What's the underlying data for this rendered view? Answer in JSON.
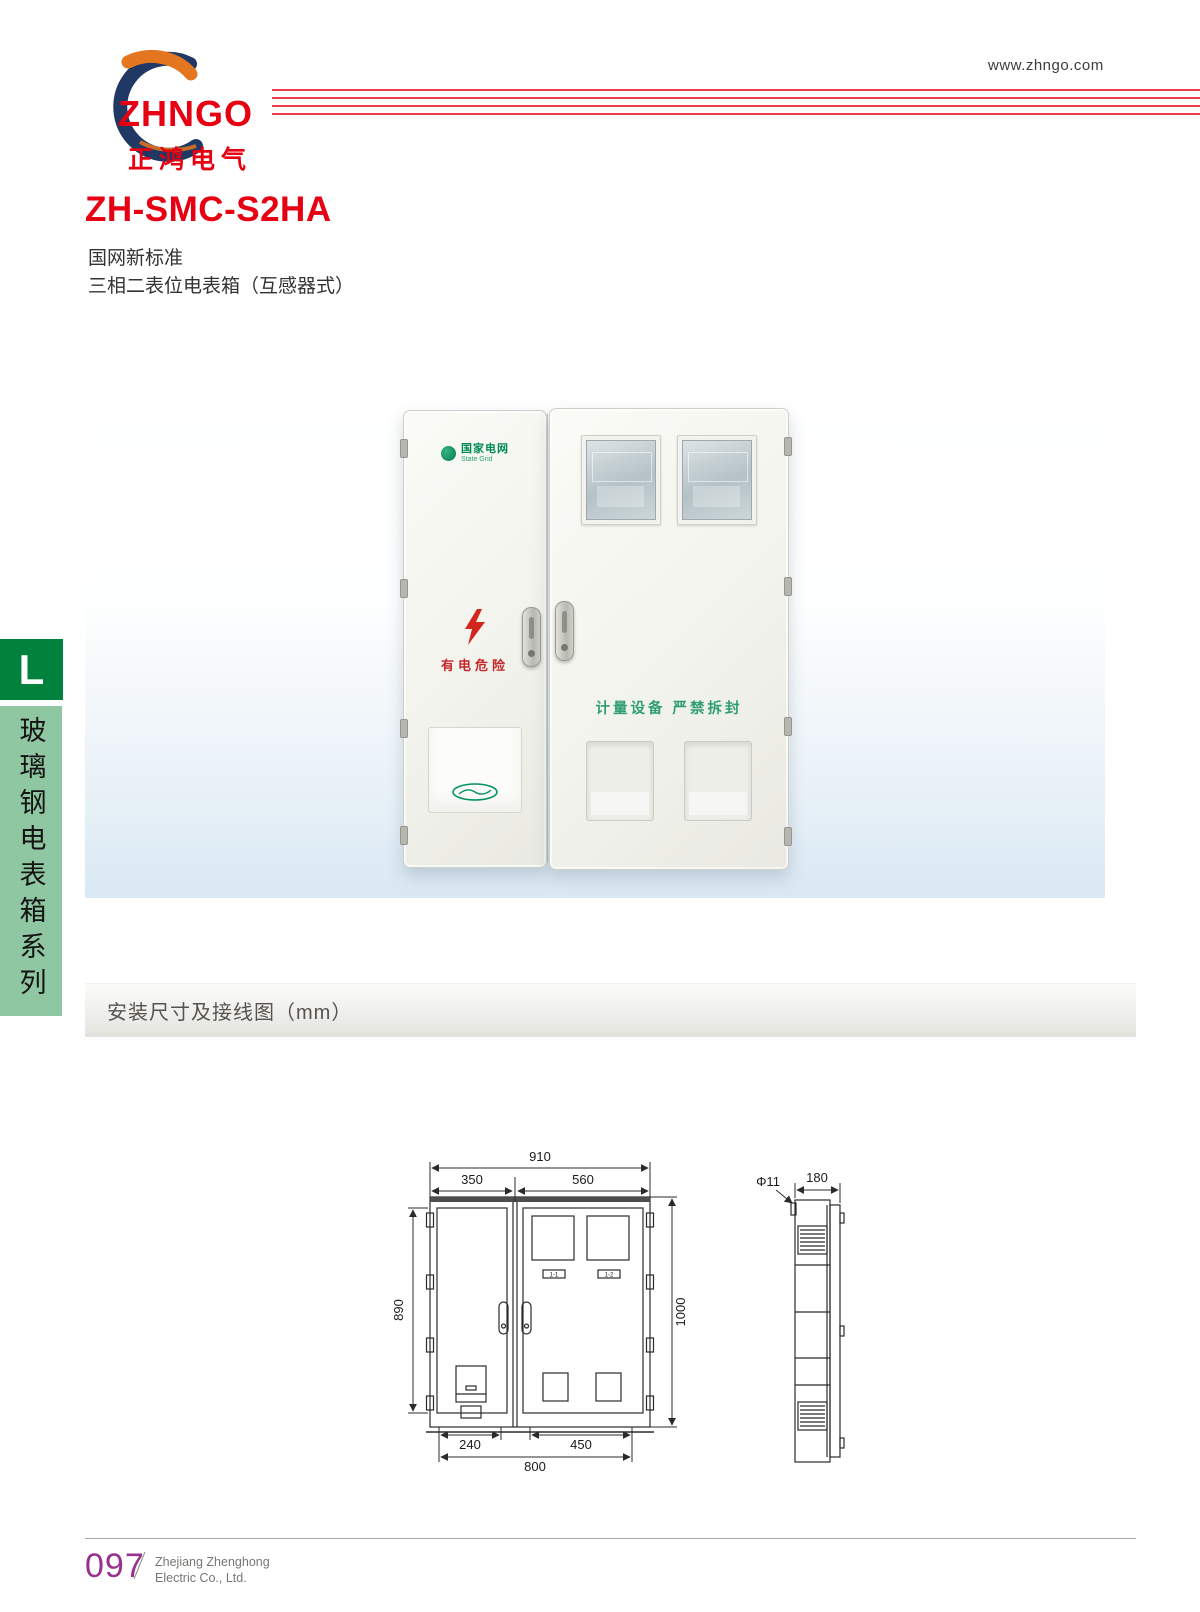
{
  "header": {
    "brand": "ZHNGO",
    "brand_cn": "正鸿电气",
    "website": "www.zhngo.com"
  },
  "product": {
    "model": "ZH-SMC-S2HA",
    "standard": "国网新标准",
    "description": "三相二表位电表箱（互感器式）"
  },
  "sidebar": {
    "letter": "L",
    "series": "玻璃钢电表箱系列"
  },
  "photo": {
    "grid_logo": "国家电网",
    "grid_logo_en": "State Grid",
    "danger": "有电危险",
    "seal": "计量设备 严禁拆封"
  },
  "section": {
    "title": "安装尺寸及接线图（mm）"
  },
  "drawing": {
    "front": {
      "width_total": "910",
      "width_left": "350",
      "width_right": "560",
      "height_door": "890",
      "height_total": "1000",
      "bottom_left": "240",
      "bottom_right": "450",
      "bottom_total": "800",
      "window_label_1": "1-1",
      "window_label_2": "1-2"
    },
    "side": {
      "hole": "Φ11",
      "depth": "180"
    }
  },
  "footer": {
    "page": "097",
    "company_l1": "Zhejiang Zhenghong",
    "company_l2": "Electric Co., Ltd."
  },
  "colors": {
    "accent_red": "#e60012",
    "line_red": "#ee3a49",
    "sidebar_green_dark": "#00813c",
    "sidebar_green_light": "#8fc7a2",
    "grid_green": "#00925c",
    "page_purple": "#97308f",
    "drawing_ink": "#2b2b2b"
  }
}
